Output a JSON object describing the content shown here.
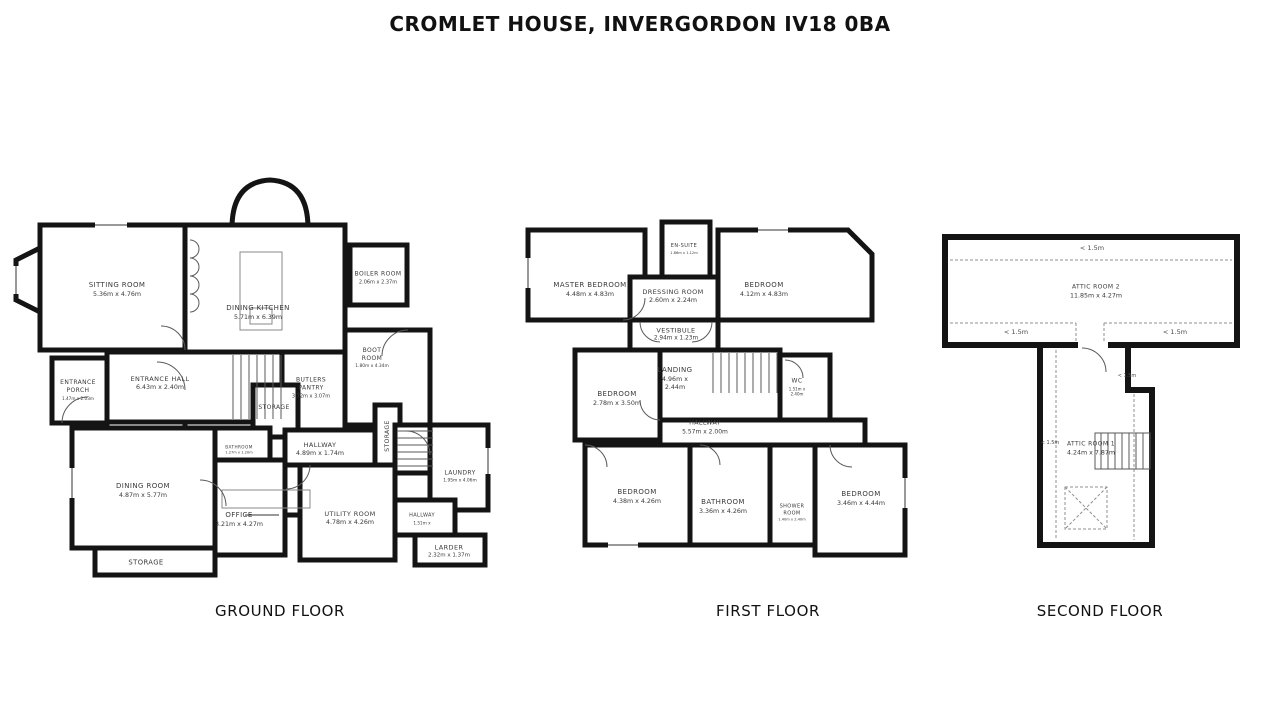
{
  "title": "CROMLET HOUSE, INVERGORDON IV18 0BA",
  "floors": {
    "ground": {
      "caption": "GROUND FLOOR",
      "rooms": {
        "sitting_room": {
          "name": "SITTING ROOM",
          "dims": "5.36m x 4.76m"
        },
        "dining_kitchen": {
          "name": "DINING KITCHEN",
          "dims": "5.71m x 6.39m"
        },
        "boiler_room": {
          "name": "BOILER ROOM",
          "dims": "2.06m x 2.37m"
        },
        "boot_room": {
          "name": "BOOT ROOM",
          "dims": "1.80m x 4.34m"
        },
        "entrance_porch": {
          "name": "ENTRANCE PORCH",
          "dims": "1.47m x 2.03m"
        },
        "entrance_hall": {
          "name": "ENTRANCE HALL",
          "dims": "6.43m x 2.40m"
        },
        "butlers_pantry": {
          "name": "BUTLERS PANTRY",
          "dims": "3.72m x 3.07m"
        },
        "storage_mid": {
          "name": "STORAGE"
        },
        "storage_side": {
          "name": "STORAGE"
        },
        "storage_bottom": {
          "name": "STORAGE"
        },
        "hallway": {
          "name": "HALLWAY",
          "dims": "4.89m x 1.74m"
        },
        "bathroom": {
          "name": "BATHROOM",
          "dims": "1.27m x 1.20m"
        },
        "dining_room": {
          "name": "DINING ROOM",
          "dims": "4.87m x 5.77m"
        },
        "office": {
          "name": "OFFICE",
          "dims": "3.21m x 4.27m"
        },
        "utility_room": {
          "name": "UTILITY ROOM",
          "dims": "4.78m x 4.26m"
        },
        "hallway_small": {
          "name": "HALLWAY",
          "dims": "1.51m x"
        },
        "laundry": {
          "name": "LAUNDRY",
          "dims": "1.95m x 4.06m"
        },
        "larder": {
          "name": "LARDER",
          "dims": "2.32m x 1.37m"
        }
      }
    },
    "first": {
      "caption": "FIRST FLOOR",
      "rooms": {
        "master_bedroom": {
          "name": "MASTER BEDROOM",
          "dims": "4.48m x 4.83m"
        },
        "en_suite": {
          "name": "EN-SUITE",
          "dims": "1.86m x 1.12m"
        },
        "dressing_room": {
          "name": "DRESSING ROOM",
          "dims": "2.60m x 2.24m"
        },
        "bedroom_1": {
          "name": "BEDROOM",
          "dims": "4.12m x 4.83m"
        },
        "vestibule": {
          "name": "VESTIBULE",
          "dims": "2.94m x 1.23m"
        },
        "bedroom_2": {
          "name": "BEDROOM",
          "dims": "2.78m x 3.50m"
        },
        "landing": {
          "name": "LANDING",
          "dims": "4.96m x 2.44m"
        },
        "wc": {
          "name": "WC",
          "dims": "1.51m x 2.40m"
        },
        "hallway": {
          "name": "HALLWAY",
          "dims": "5.57m x 2.00m"
        },
        "bedroom_3": {
          "name": "BEDROOM",
          "dims": "4.38m x 4.26m"
        },
        "bathroom": {
          "name": "BATHROOM",
          "dims": "3.36m x 4.26m"
        },
        "shower_room": {
          "name": "SHOWER ROOM",
          "dims": "1.40m x 2.40m"
        },
        "bedroom_4": {
          "name": "BEDROOM",
          "dims": "3.46m x 4.44m"
        }
      }
    },
    "second": {
      "caption": "SECOND FLOOR",
      "head_height": "< 1.5m",
      "rooms": {
        "attic_room_2": {
          "name": "ATTIC ROOM 2",
          "dims": "11.85m x 4.27m"
        },
        "attic_room_1": {
          "name": "ATTIC ROOM 1",
          "dims": "4.24m x 7.87m"
        }
      }
    }
  }
}
